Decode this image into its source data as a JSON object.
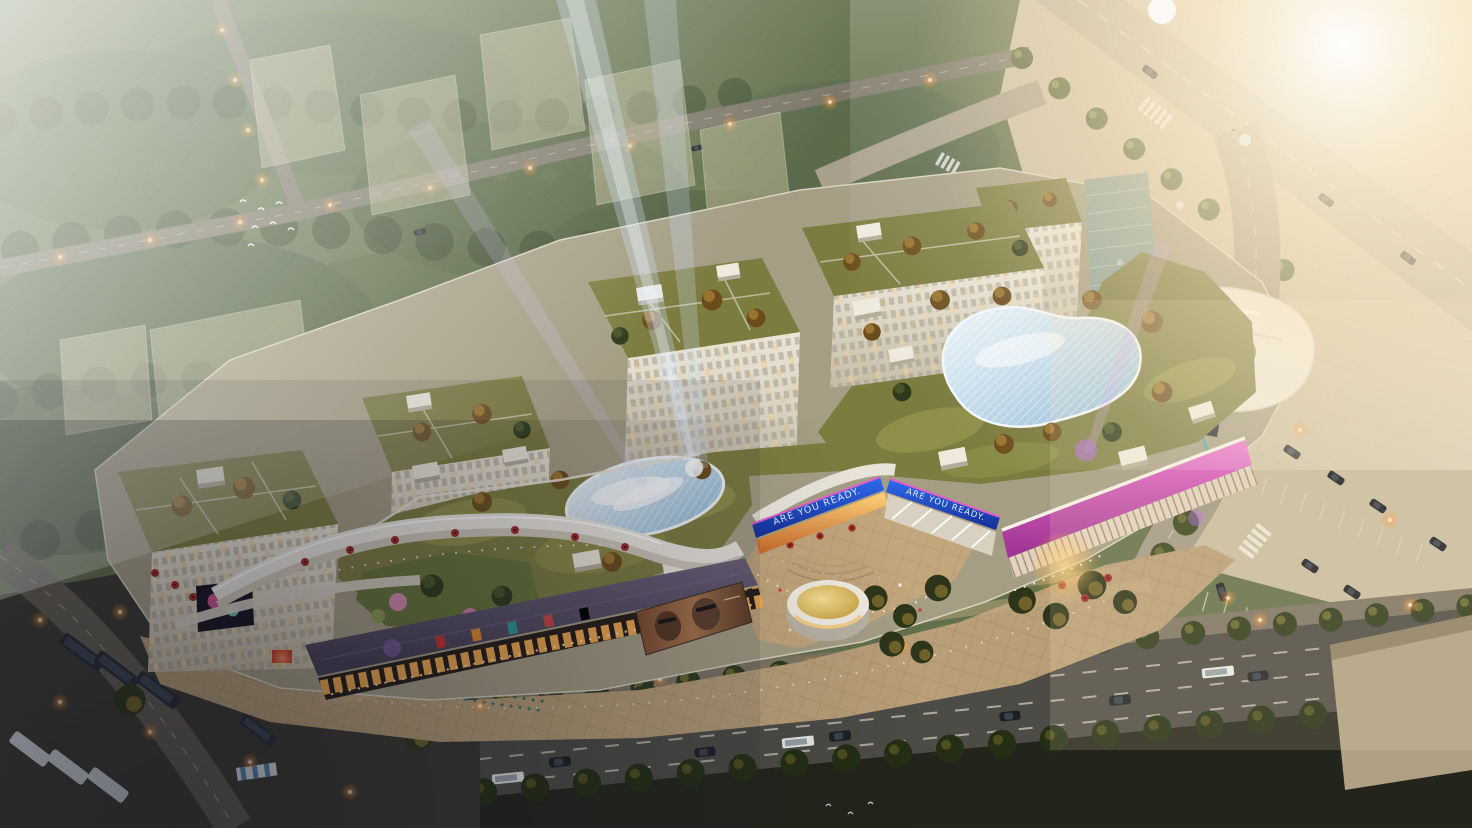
{
  "banners": {
    "left": "ARE YOU READY.",
    "right": "ARE YOU READY."
  },
  "colors": {
    "banner_blue": "#1d4fc4",
    "facade_magenta": "#c94fae",
    "roof_band_purple": "#534a63",
    "glass_canopy_blue": "#aecde2",
    "roof_garden_olive": "#7c7c40",
    "plaza_paving_tan": "#b99f78",
    "sunlight_warm": "#ffe9c4",
    "asphalt_dark": "#4c4b46",
    "tree_dark_olive": "#39451f",
    "tree_autumn": "#8a6a28",
    "pavilion_gold": "#e0bd5e",
    "storefront_warm": "#f2a94e"
  }
}
